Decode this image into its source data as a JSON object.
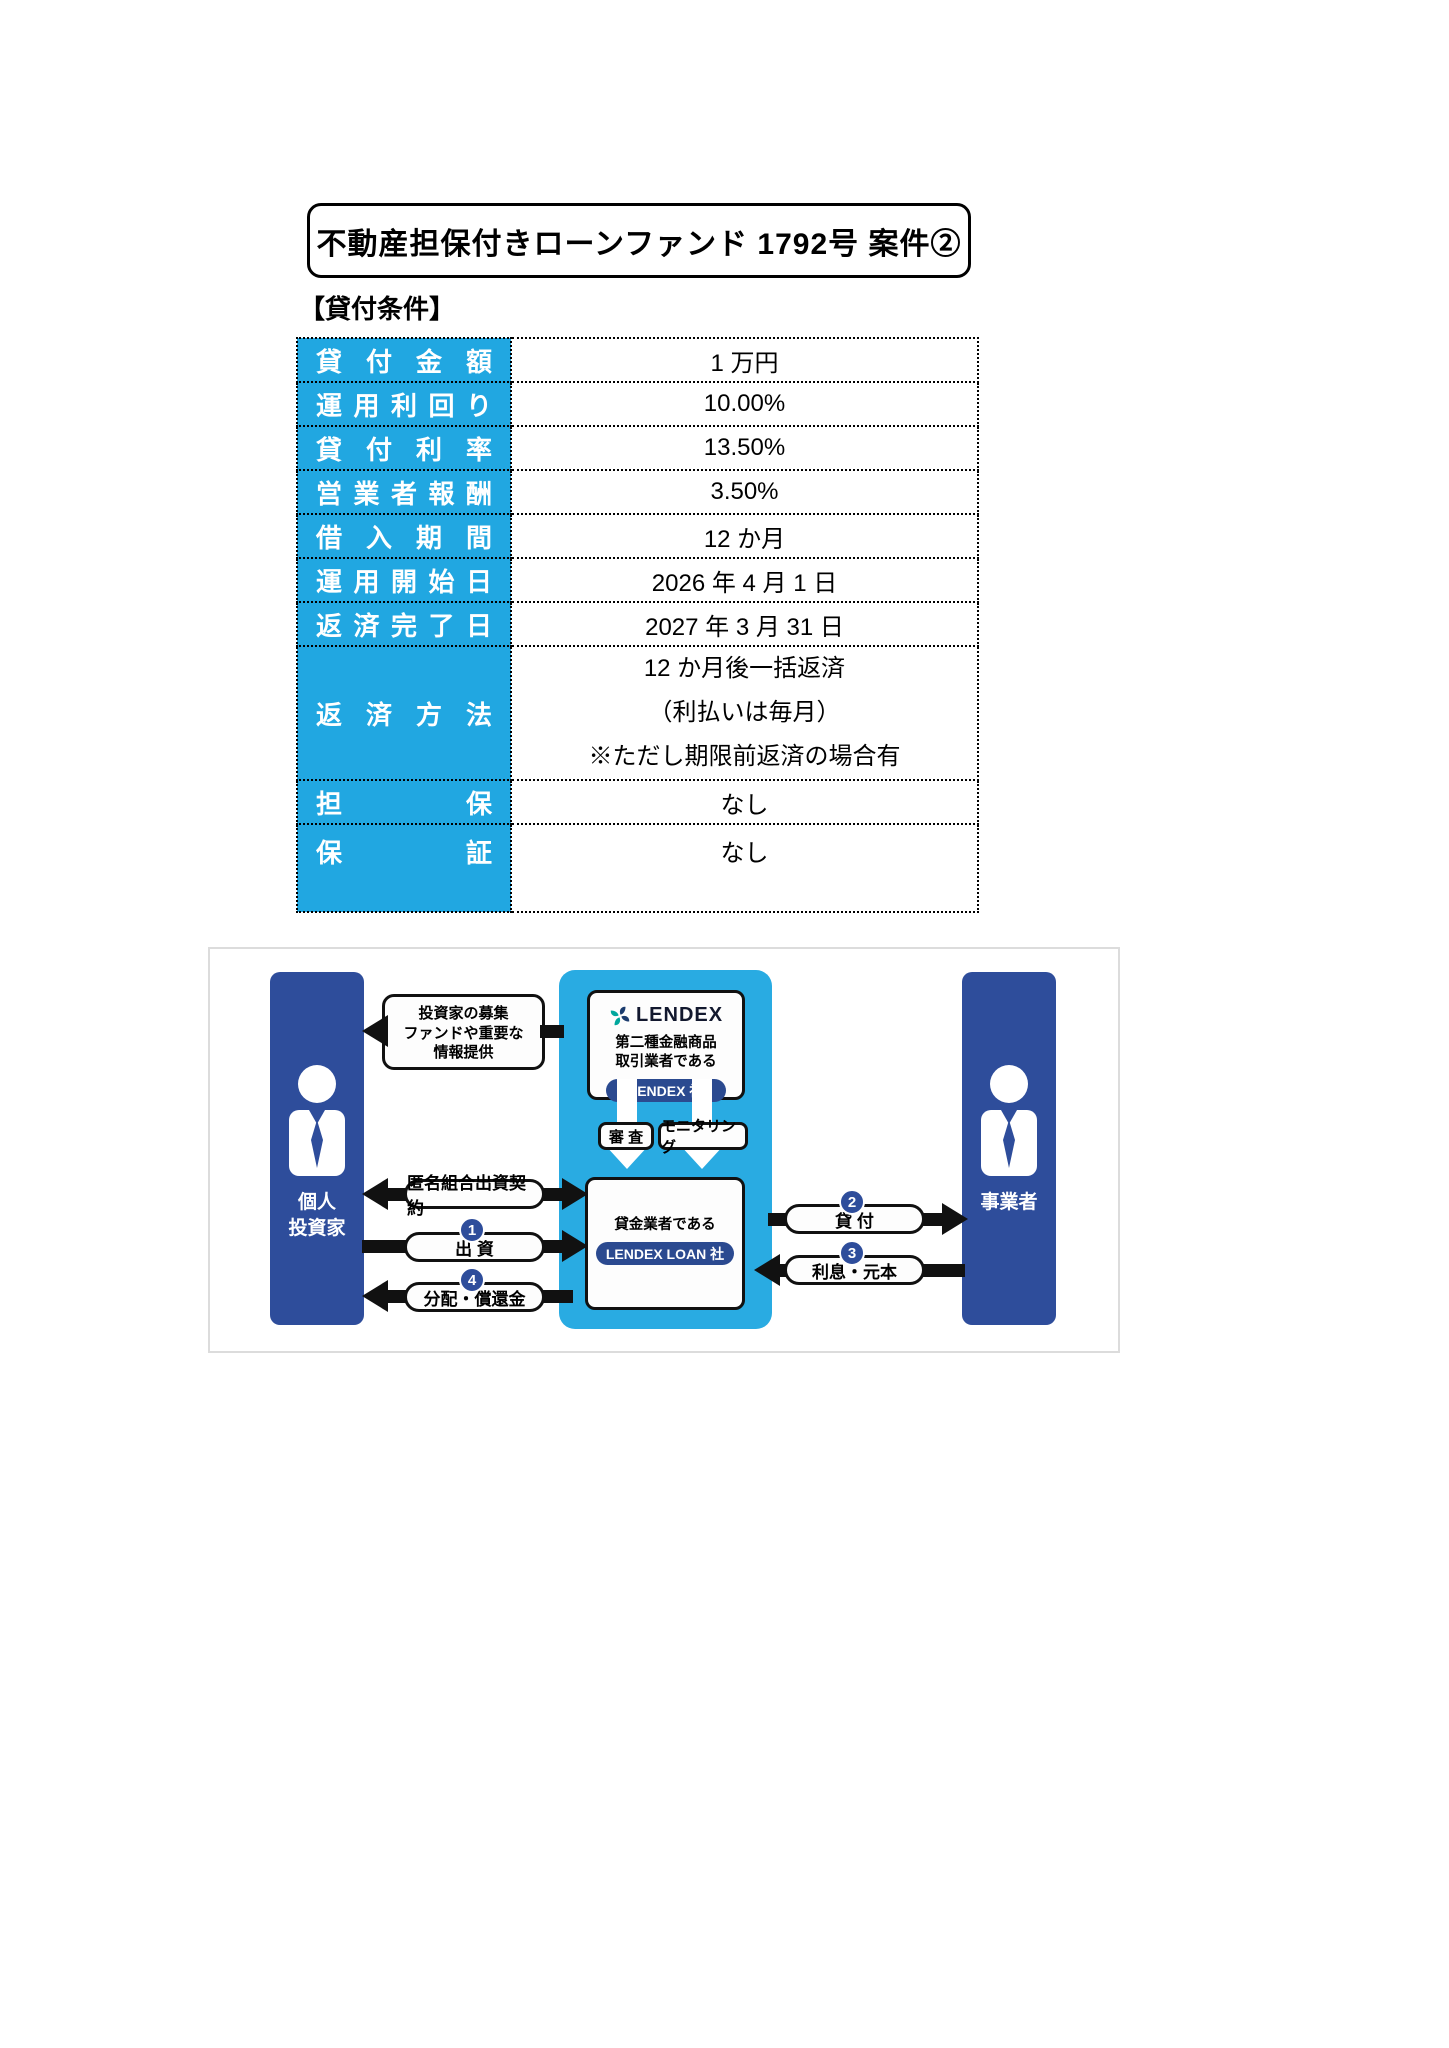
{
  "title": "不動産担保付きローンファンド 1792号 案件②",
  "section_heading": "【貸付条件】",
  "loan_table": {
    "rows": [
      {
        "label": "貸付金額",
        "value": "1 万円"
      },
      {
        "label": "運用利回り",
        "value": "10.00%"
      },
      {
        "label": "貸付利率",
        "value": "13.50%"
      },
      {
        "label": "営業者報酬",
        "value": "3.50%"
      },
      {
        "label": "借入期間",
        "value": "12 か月"
      },
      {
        "label": "運用開始日",
        "value": "2026 年 4 月 1 日"
      },
      {
        "label": "返済完了日",
        "value": "2027 年 3 月 31 日"
      },
      {
        "label": "返済方法",
        "value_lines": [
          "12 か月後一括返済",
          "（利払いは毎月）",
          "※ただし期限前返済の場合有"
        ]
      },
      {
        "label": "担保",
        "value": "なし"
      },
      {
        "label": "保証",
        "value": "なし"
      }
    ]
  },
  "diagram": {
    "investor": {
      "line1": "個人",
      "line2": "投資家"
    },
    "business": {
      "label": "事業者"
    },
    "lendex_box": {
      "logo": "LENDEX",
      "desc1": "第二種金融商品",
      "desc2": "取引業者である",
      "pill": "LENDEX 社"
    },
    "loan_company_box": {
      "desc": "貸金業者である",
      "pill": "LENDEX LOAN 社"
    },
    "check_labels": {
      "shinsa": "審 査",
      "monitoring": "モニタリング"
    },
    "info_box": {
      "line1": "投資家の募集",
      "line2": "ファンドや重要な",
      "line3": "情報提供"
    },
    "flows": {
      "contract": {
        "label": "匿名組合出資契約"
      },
      "investment": {
        "num": "1",
        "label": "出 資"
      },
      "distribution": {
        "num": "4",
        "label": "分配・償還金"
      },
      "lending": {
        "num": "2",
        "label": "貸 付"
      },
      "repayment": {
        "num": "3",
        "label": "利息・元本"
      }
    },
    "colors": {
      "navy": "#2e4d9b",
      "light_blue": "#29abe2",
      "table_header_blue": "#21a7e1",
      "teal": "#00a79d",
      "pill_navy": "#2b4a90"
    }
  }
}
